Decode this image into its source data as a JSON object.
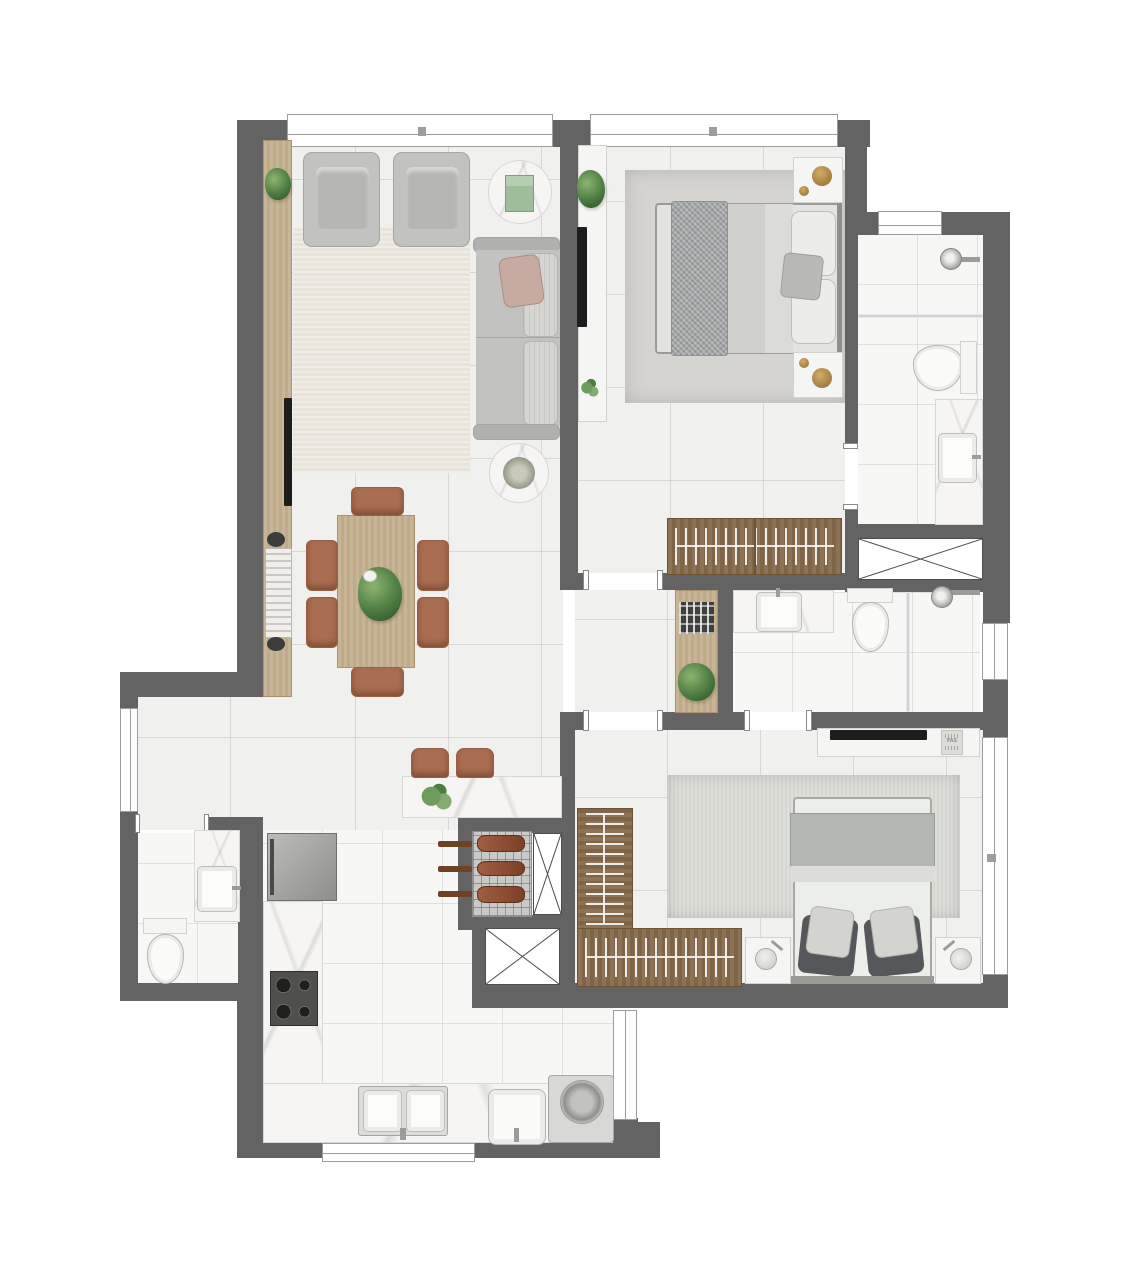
{
  "canvas": {
    "width": 1127,
    "height": 1280
  },
  "title": "apartment-floor-plan",
  "watermark": {
    "text": "FAS"
  },
  "palette": {
    "wall": "#636363",
    "floor": "#f0f0ee",
    "bath_floor": "#f7f7f6",
    "marble": "#f6f5f3",
    "wood_light": "#c8b596",
    "wood_dark": "#8d7355",
    "rug_living": "#e8e4da",
    "rug_suite": "#d6d4d1",
    "rug_bedroom2": "#d4d6d0",
    "sofa": "#c2c3c0",
    "cushion": "#d5d6d2",
    "blush": "#c7aba1",
    "terracotta": "#a96d51",
    "plant_green": "#4d7c41",
    "metal": "#9c9c9a",
    "tv_black": "#1d1d1d"
  },
  "rooms": [
    {
      "id": "living-room",
      "furniture": [
        "wood sideboard with plants and books",
        "two armchairs",
        "round marble side table with green book",
        "three-seat sofa with blush pillow",
        "round marble coffee table",
        "beige rug"
      ]
    },
    {
      "id": "dining-area",
      "furniture": [
        "wood dining table",
        "six terracotta chairs",
        "plant centerpiece",
        "marble bar counter with flowers",
        "two terracotta stools"
      ]
    },
    {
      "id": "kitchen",
      "furniture": [
        "refrigerator",
        "four-burner cooktop",
        "L-shaped marble counter",
        "double sink",
        "charcoal grill with three skewers"
      ]
    },
    {
      "id": "powder-room",
      "furniture": [
        "toilet",
        "marble washbasin counter"
      ]
    },
    {
      "id": "suite-bedroom",
      "furniture": [
        "double bed with knit throw",
        "two nightstands with gold decor",
        "hanger wardrobe",
        "tv panel with plant",
        "gray rug"
      ]
    },
    {
      "id": "suite-bathroom",
      "furniture": [
        "shower with glass partition",
        "toilet",
        "marble washbasin counter"
      ]
    },
    {
      "id": "bathroom-2",
      "furniture": [
        "marble washbasin counter",
        "toilet",
        "shower with glass partition"
      ]
    },
    {
      "id": "bedroom-2",
      "furniture": [
        "double bed with dark pillows",
        "two nightstands with lamps",
        "L-shaped open closet with hangers",
        "tv shelf",
        "green-gray rug"
      ]
    },
    {
      "id": "laundry",
      "furniture": [
        "laundry tub",
        "top-load washing machine"
      ]
    },
    {
      "id": "shafts",
      "furniture": [
        "ventilation shaft x3"
      ]
    }
  ]
}
